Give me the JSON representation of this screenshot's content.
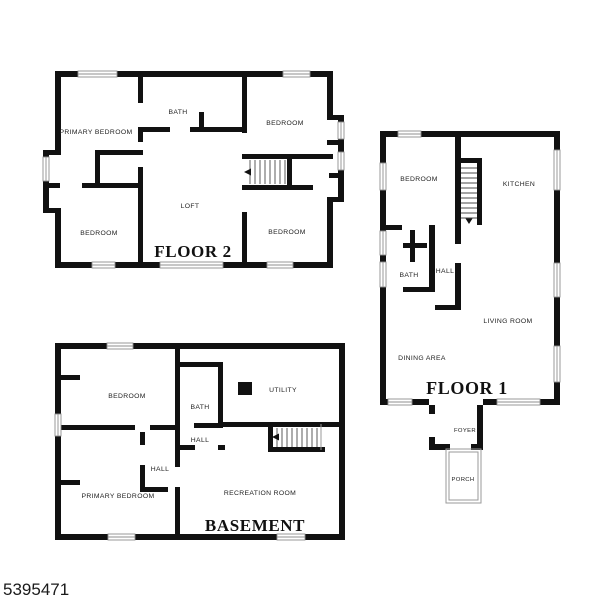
{
  "page": {
    "footer_id": "5395471"
  },
  "floor2": {
    "title": "FLOOR 2",
    "rooms": {
      "primary_bedroom": "PRIMARY BEDROOM",
      "bath": "BATH",
      "bedroom_top_right": "BEDROOM",
      "loft": "LOFT",
      "bedroom_bottom_left": "BEDROOM",
      "bedroom_bottom_right": "BEDROOM"
    }
  },
  "floor1": {
    "title": "FLOOR 1",
    "rooms": {
      "bedroom": "BEDROOM",
      "kitchen": "KITCHEN",
      "bath": "BATH",
      "hall": "HALL",
      "living_room": "LIVING ROOM",
      "dining_area": "DINING AREA",
      "foyer": "FOYER",
      "porch": "PORCH"
    }
  },
  "basement": {
    "title": "BASEMENT",
    "rooms": {
      "bedroom": "BEDROOM",
      "bath": "BATH",
      "hall_upper": "HALL",
      "utility": "UTILITY",
      "hall_lower": "HALL",
      "primary_bedroom": "PRIMARY BEDROOM",
      "recreation_room": "RECREATION ROOM"
    }
  },
  "colors": {
    "wall": "#111111",
    "window_stroke": "#8f8f8f",
    "label": "#222222"
  }
}
